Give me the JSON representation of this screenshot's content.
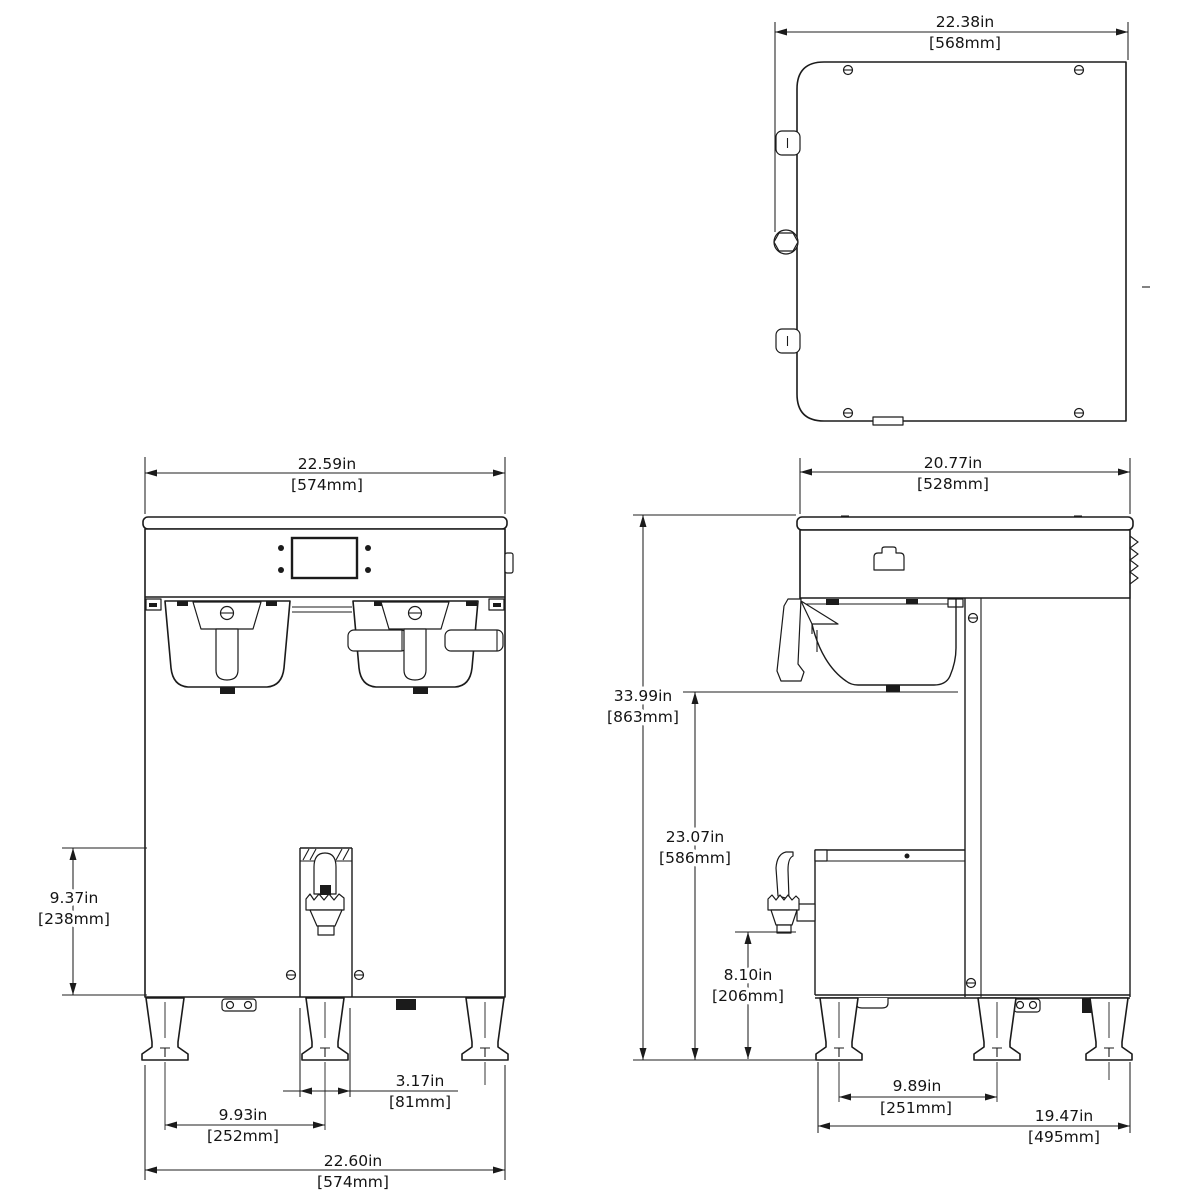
{
  "drawing": {
    "title": "coffee-brewer-dimension-drawing",
    "colors": {
      "line": "#1b1b1b",
      "background": "#ffffff"
    },
    "views": {
      "top": {
        "name": "top view"
      },
      "front": {
        "name": "front view"
      },
      "side": {
        "name": "side view"
      }
    },
    "dimensions": {
      "top_width": {
        "in": "22.38in",
        "mm": "[568mm]"
      },
      "front_top_width": {
        "in": "22.59in",
        "mm": "[574mm]"
      },
      "side_top_width": {
        "in": "20.77in",
        "mm": "[528mm]"
      },
      "server_height": {
        "in": "9.37in",
        "mm": "[238mm]"
      },
      "overall_height": {
        "in": "33.99in",
        "mm": "[863mm]"
      },
      "funnel_clearance": {
        "in": "23.07in",
        "mm": "[586mm]"
      },
      "faucet_clearance": {
        "in": "8.10in",
        "mm": "[206mm]"
      },
      "front_leg_spacing": {
        "in": "9.93in",
        "mm": "[252mm]"
      },
      "server_stand_width": {
        "in": "3.17in",
        "mm": "[81mm]"
      },
      "front_overall_width": {
        "in": "22.60in",
        "mm": "[574mm]"
      },
      "side_leg_spacing": {
        "in": "9.89in",
        "mm": "[251mm]"
      },
      "side_leg_depth": {
        "in": "19.47in",
        "mm": "[495mm]"
      }
    }
  }
}
